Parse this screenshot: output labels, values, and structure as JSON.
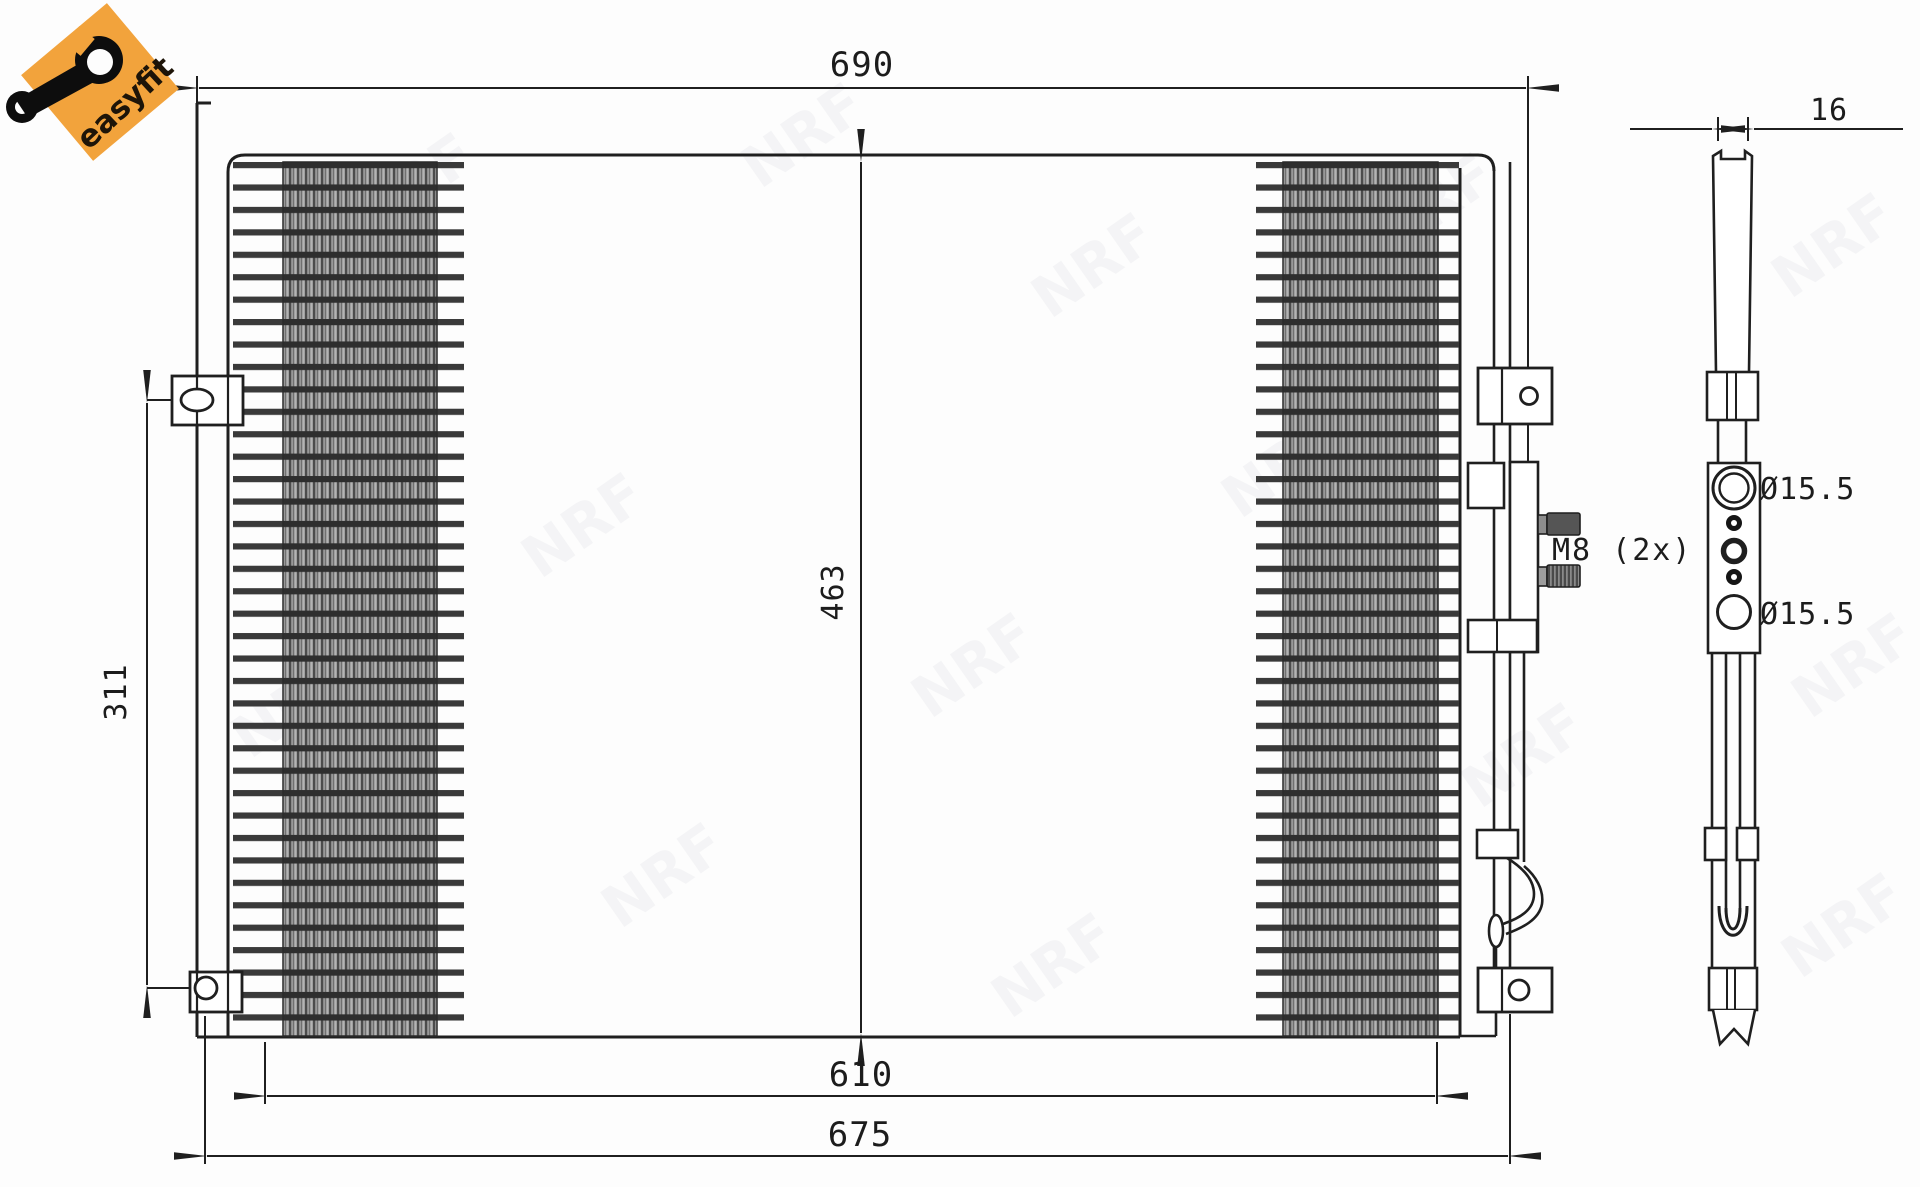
{
  "badge": {
    "label": "easyfit"
  },
  "watermark": {
    "text": "NRF"
  },
  "dimensions": {
    "top_width": "690",
    "core_height": "463",
    "bracket_spacing": "311",
    "bottom_inner_width": "610",
    "bottom_outer_width": "675",
    "depth": "16"
  },
  "labels": {
    "bolt": "M8 (2x)",
    "port_top": "Ø15.5",
    "port_bottom": "Ø15.5"
  },
  "colors": {
    "line": "#1f1f1f",
    "badge_orange": "#f2a33c",
    "fin_dark": "#3a3a3a",
    "background": "#fdfdfd"
  }
}
